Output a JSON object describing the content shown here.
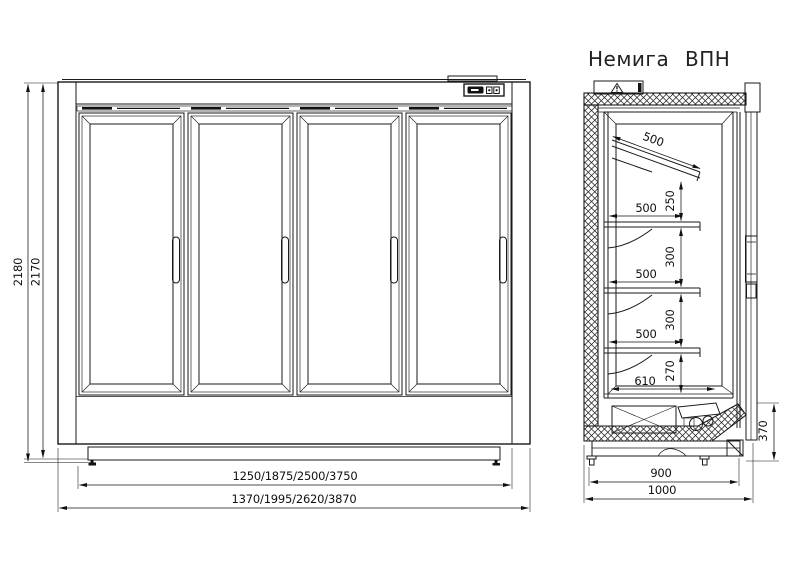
{
  "drawing": {
    "background": "#ffffff",
    "line_color": "#1a1a1a",
    "type": "technical-drawing"
  },
  "front": {
    "door_count": 4,
    "dims": {
      "height_outer": "2180",
      "height_inner": "2170",
      "width_inner": "1250/1875/2500/3750",
      "width_outer": "1370/1995/2620/3870"
    }
  },
  "side": {
    "title": "Немига ВПН",
    "dims": {
      "canopy": "500",
      "canopy_gap": "250",
      "shelf1": "500",
      "gap1": "300",
      "shelf2": "500",
      "gap2": "300",
      "shelf3": "500",
      "gap3": "270",
      "floor": "610",
      "machine_h": "370",
      "depth_inner": "900",
      "depth_outer": "1000"
    }
  }
}
